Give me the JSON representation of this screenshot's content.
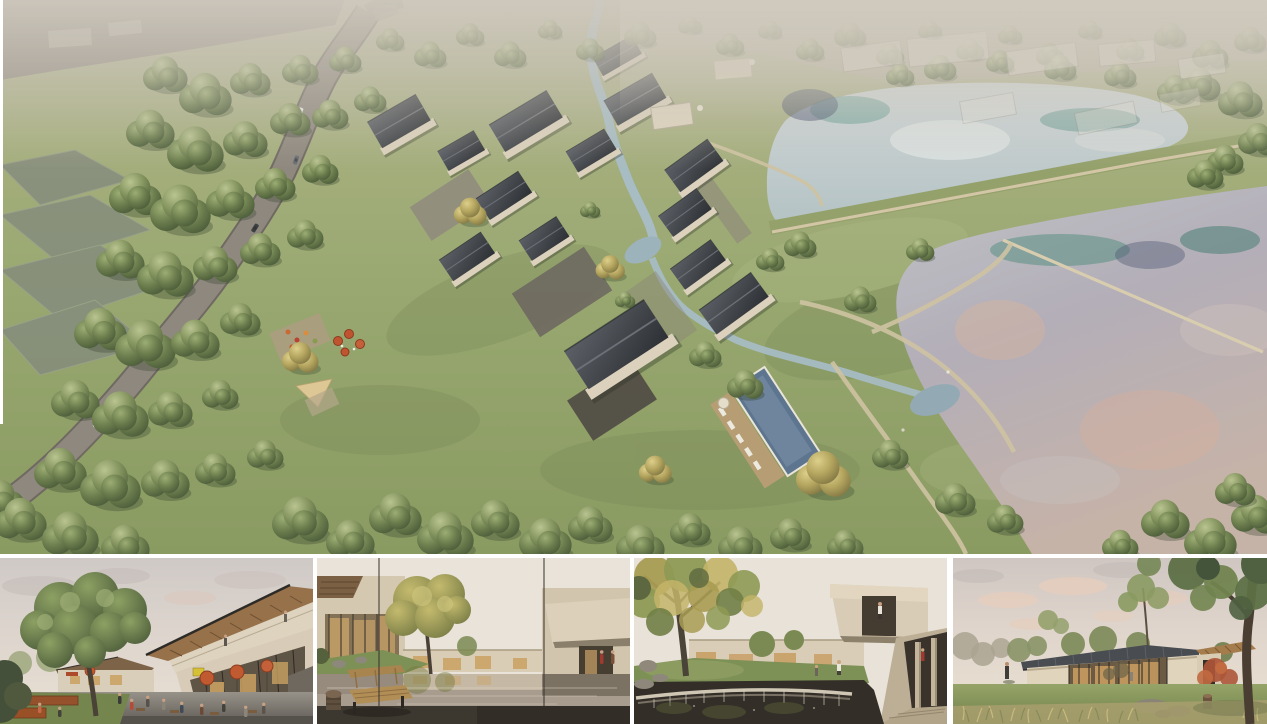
{
  "board": {
    "kind": "architectural rendering presentation board",
    "background_color": "#ffffff",
    "label": "Rendering board: aerial masterplan view above four eye-level views"
  },
  "panels": {
    "hero": {
      "name": "aerial-masterplan-render",
      "label": "Aerial rendering of a courtyard village resort: cluster of dark pitched-roof buildings with cream walls beside two large ponds separated by a grass dam, a curving grey access road with cars on the left, dense tree masses, a winding stream, a slate-blue swimming pool with timber deck, beige footpaths to the lake, and translucent ghost massing of a future phase at the top"
    },
    "thumbnails": [
      {
        "name": "plaza-cafe-view",
        "label": "Street-level view of the village plaza: two-storey building with rising timber-soffit roof, glazed shopfronts, terracotta cafe umbrellas, people at tables, large green tree and corten planters"
      },
      {
        "name": "reflecting-pool-courtyard",
        "label": "Courtyard with a still reflecting pool mirroring cream buildings, wooden slat bench and carved stool in the dark foreground, autumn tree and grass mound with rocks"
      },
      {
        "name": "pond-waterfall-courtyard",
        "label": "Water court with a stone weir and small waterfall in the foreground pond, mottled sycamore tree, cantilevered cream balcony with a visitor, and a shaded stone colonnade"
      },
      {
        "name": "lawn-pavilion-view",
        "label": "Single-storey glazed pavilion with dark standing-seam roof and timber wing on a lawn at dusk, warm interior glow, red maple, rocks and dry grasses, large tree in the right foreground"
      }
    ]
  },
  "palette": {
    "grass": "#97a76f",
    "forest_green": "#4d5e3b",
    "autumn_yellow": "#b3a45e",
    "roof_dark": "#2d3034",
    "wall_cream": "#dbd1bc",
    "road_grey": "#8e887e",
    "stream_blue": "#a7bcc3",
    "upper_pond": "#c4ced0",
    "lower_lake_lavender": "#b3aeb8",
    "reflection_teal": "#4f8c7e",
    "reflection_peach": "#d8b49e",
    "pool_blue": "#5e7590",
    "deck_wood": "#b79d73",
    "path_beige": "#cfc3a2",
    "umbrella_terracotta": "#c05a30",
    "interior_glow": "#c9a162",
    "sky_haze": "#d0cabf"
  }
}
